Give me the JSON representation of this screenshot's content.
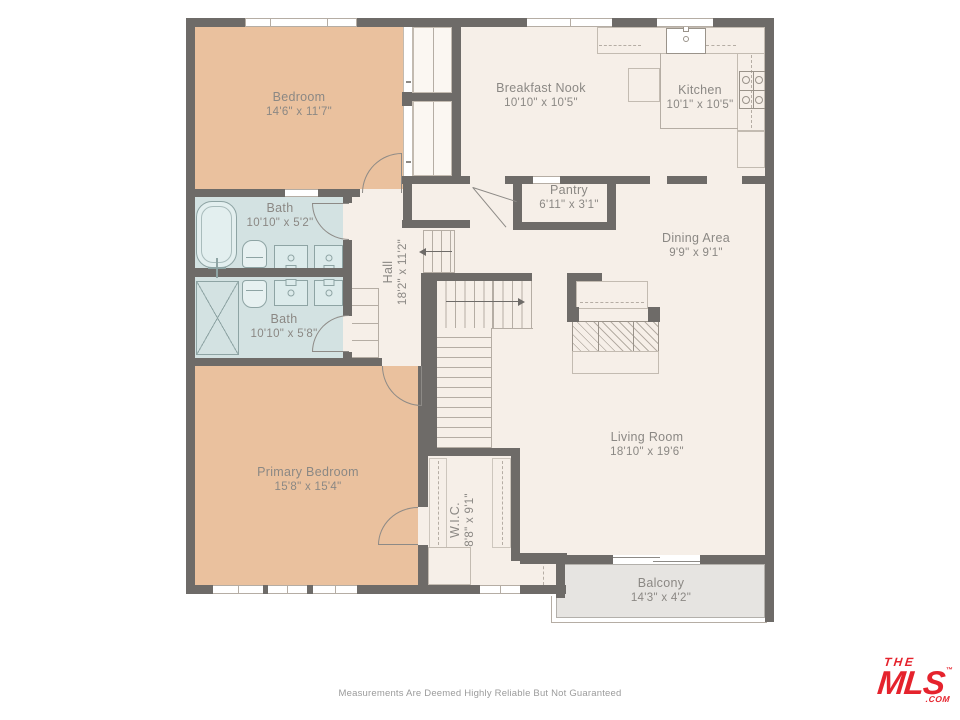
{
  "page": {
    "footer_disclaimer": "Measurements Are Deemed Highly Reliable But Not Guaranteed"
  },
  "logo": {
    "line1": "THE",
    "line2": "MLS",
    "trademark": "™",
    "suffix": ".COM",
    "color": "#e5232d"
  },
  "colors": {
    "wall": "#6e6b68",
    "floor_cream": "#f6efe8",
    "bedroom_tan": "#eac19e",
    "bath_blue": "#d3e2e2",
    "balcony_gray": "#e6e4e1",
    "detail_line": "#b5ada4",
    "fixture_line": "#8ea4a4",
    "label_text": "#8b8884",
    "footer_text": "#9b9b9b"
  },
  "rooms": {
    "bedroom": {
      "name": "Bedroom",
      "dims": "14'6\" x 11'7\""
    },
    "breakfast_nook": {
      "name": "Breakfast Nook",
      "dims": "10'10\" x 10'5\""
    },
    "kitchen": {
      "name": "Kitchen",
      "dims": "10'1\" x 10'5\""
    },
    "pantry": {
      "name": "Pantry",
      "dims": "6'11\" x 3'1\""
    },
    "dining": {
      "name": "Dining Area",
      "dims": "9'9\" x 9'1\""
    },
    "bath_upper": {
      "name": "Bath",
      "dims": "10'10\" x 5'2\""
    },
    "bath_lower": {
      "name": "Bath",
      "dims": "10'10\" x 5'8\""
    },
    "hall": {
      "name": "Hall",
      "dims": "18'2\" x 11'2\""
    },
    "living": {
      "name": "Living Room",
      "dims": "18'10\" x 19'6\""
    },
    "primary": {
      "name": "Primary Bedroom",
      "dims": "15'8\" x 15'4\""
    },
    "wic": {
      "name": "W.I.C.",
      "dims": "8'8\" x 9'1\""
    },
    "balcony": {
      "name": "Balcony",
      "dims": "14'3\" x 4'2\""
    }
  }
}
